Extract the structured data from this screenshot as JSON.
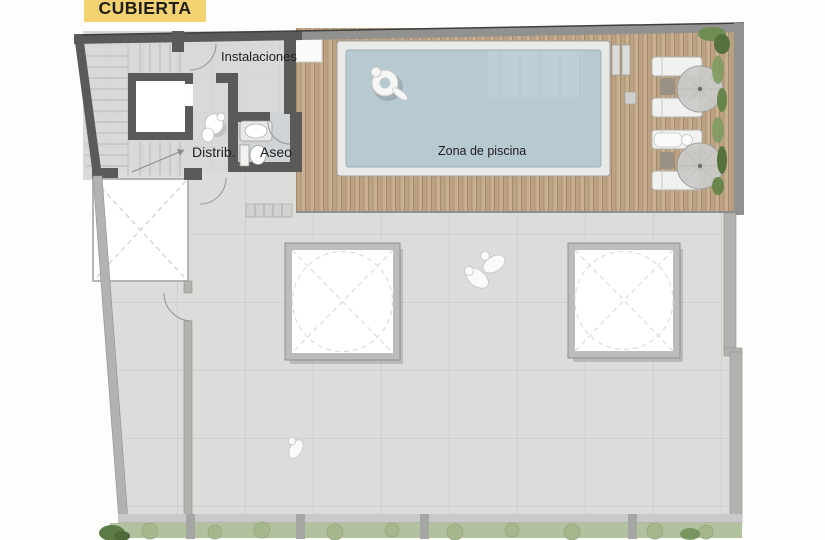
{
  "title": {
    "label": "CUBIERTA",
    "bg_color": "#f2d271",
    "text_color": "#1f1d18"
  },
  "labels": {
    "instalaciones": "Instalaciones",
    "distrib": "Distrib.",
    "aseo": "Aseo",
    "zona_piscina": "Zona de piscina"
  },
  "plan": {
    "type": "roof-terrace-floor-plan",
    "features": {
      "skylights": 2,
      "sun_loungers": 4,
      "umbrellas": 2,
      "pool": 1,
      "elevator": 1,
      "stair_flights": 3,
      "people": 5,
      "planter_strip": true
    },
    "colors": {
      "wall_dark": "#5a5a58",
      "wall_light": "#b2b2b0",
      "wall_top_right": "#919190",
      "terrace_tile": "#dcdcda",
      "tile_line": "#c8c8c6",
      "deck_wood": "#c8af90",
      "deck_wood_dark": "#bca283",
      "pool_water": "#b7cad2",
      "pool_coping": "#e9e9e7",
      "aseo_floor": "#ced4d6",
      "skylight_frame": "#bcbcba",
      "planter_green": "#b3c29e",
      "plant_green": "#6f8d53",
      "fixture_white": "#f6f6f4",
      "title_yellow": "#f2d271"
    }
  }
}
